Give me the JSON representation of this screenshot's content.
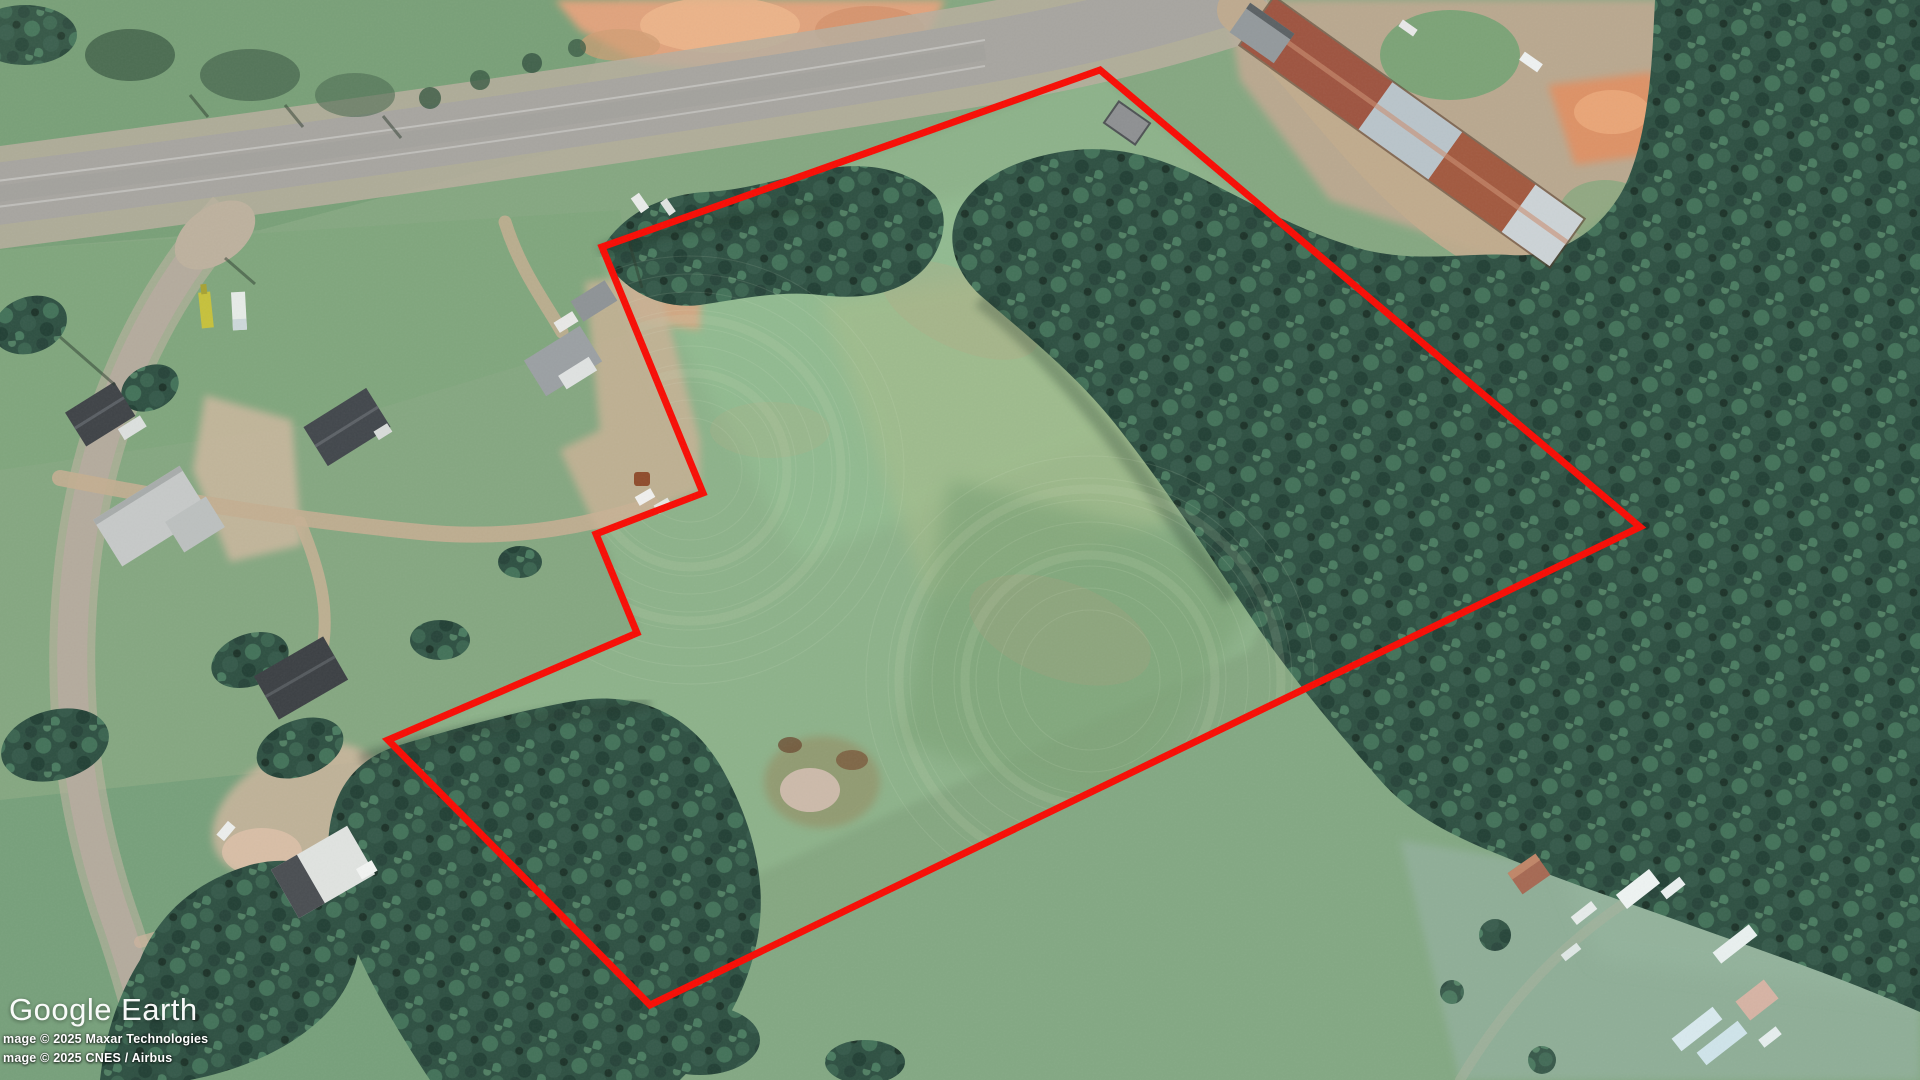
{
  "app": {
    "name": "Google Earth"
  },
  "branding": {
    "logo_text": "Google Earth"
  },
  "attribution": {
    "line1": "mage © 2025 Maxar Technologies",
    "line2": "mage © 2025 CNES / Airbus"
  },
  "map": {
    "view": "satellite-aerial-imagery",
    "boundary": {
      "color": "#f80c04",
      "stroke_width": 7,
      "points": [
        [
          1100,
          70
        ],
        [
          602,
          247
        ],
        [
          703,
          493
        ],
        [
          596,
          534
        ],
        [
          637,
          633
        ],
        [
          388,
          740
        ],
        [
          650,
          1005
        ],
        [
          1640,
          527
        ]
      ]
    }
  }
}
